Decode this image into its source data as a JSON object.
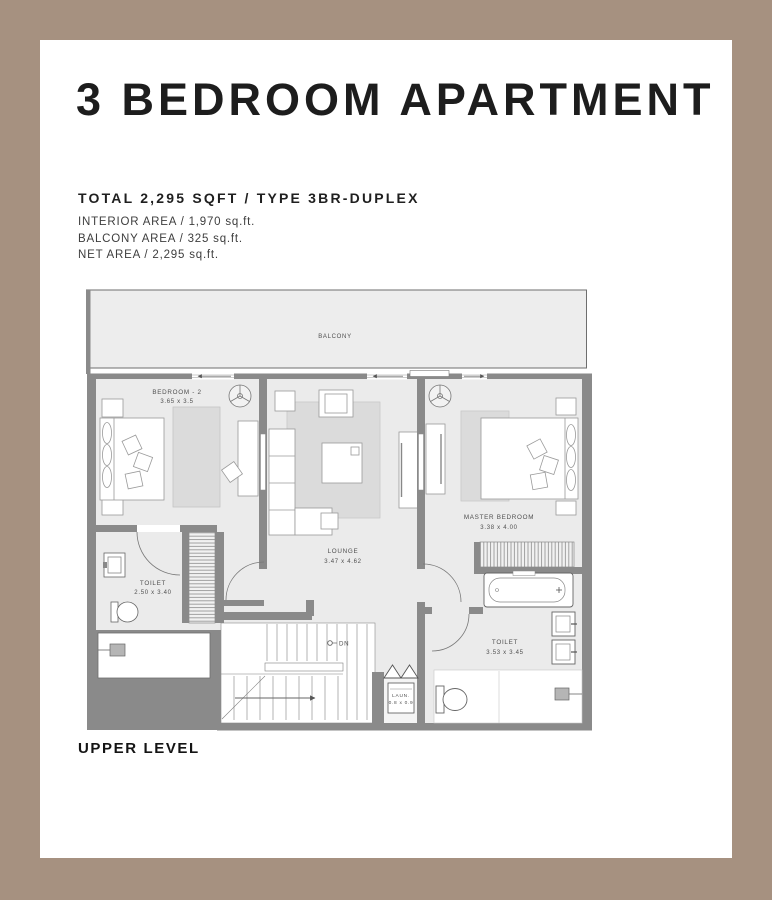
{
  "header": {
    "title": "3 BEDROOM APARTMENT",
    "spec_title": "TOTAL 2,295 SQFT / TYPE 3BR-DUPLEX",
    "specs": [
      "INTERIOR AREA / 1,970 sq.ft.",
      "BALCONY AREA / 325 sq.ft.",
      "NET AREA / 2,295 sq.ft."
    ]
  },
  "plan": {
    "level_label": "UPPER LEVEL",
    "balcony": {
      "label": "BALCONY"
    },
    "bedroom2": {
      "label": "BEDROOM - 2",
      "dims": "3.65 x 3.5"
    },
    "lounge": {
      "label": "LOUNGE",
      "dims": "3.47 x 4.62"
    },
    "master": {
      "label": "MASTER BEDROOM",
      "dims": "3.38 x 4.00"
    },
    "toilet1": {
      "label": "TOILET",
      "dims": "2.50 x 3.40"
    },
    "toilet2": {
      "label": "TOILET",
      "dims": "3.53 x 3.45"
    },
    "laundry": {
      "label": "LAUN.",
      "dims": "0.8 x 0.9"
    },
    "stairs": {
      "label": "DN"
    }
  },
  "colors": {
    "frame": "#a69180",
    "wall": "#8a8a8a",
    "floor": "#ebebeb",
    "rug": "#dbdbdb",
    "line": "#787878",
    "text": "#4f4f4f"
  }
}
